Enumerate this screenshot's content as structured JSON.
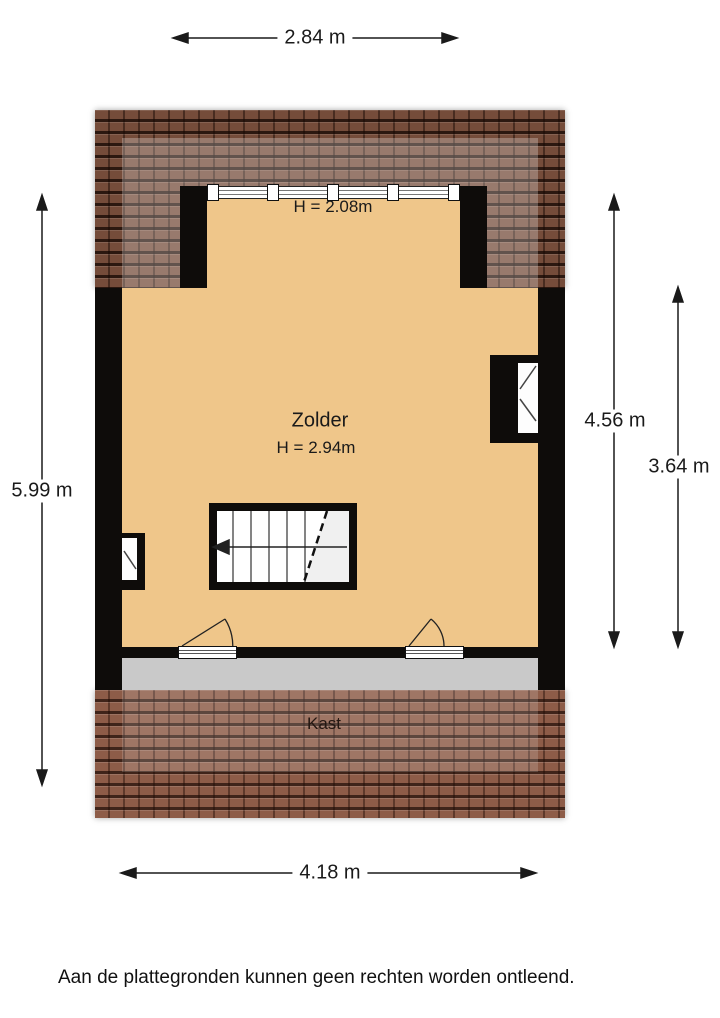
{
  "plan": {
    "room_label": "Zolder",
    "room_height_label": "H = 2.94m",
    "dormer_height_label": "H = 2.08m",
    "closet_label": "Kast"
  },
  "dimensions": {
    "top_width": "2.84 m",
    "bottom_width": "4.18 m",
    "left_height": "5.99 m",
    "right_outer_height": "4.56 m",
    "right_inner_height": "3.64 m"
  },
  "footer": {
    "disclaimer": "Aan de plattegronden kunnen geen rechten worden ontleend."
  },
  "colors": {
    "floor": "#efc68a",
    "wall": "#0e0c0a",
    "roof_top": "#754c3a",
    "roof_bottom": "#8d5c48",
    "closet_floor": "#c9c9c9",
    "annotation": "#1a1a1a",
    "background": "#ffffff"
  }
}
